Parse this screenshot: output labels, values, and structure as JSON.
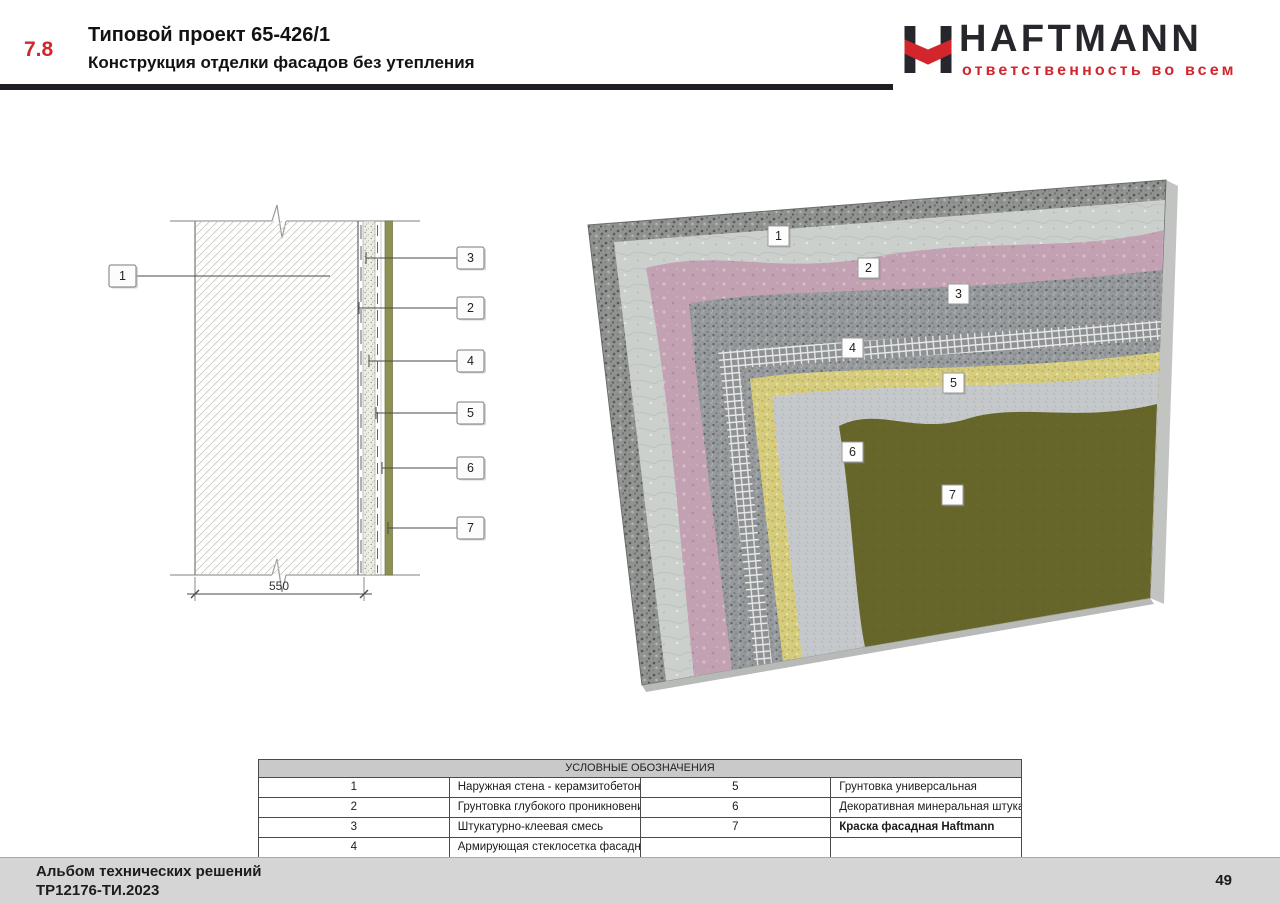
{
  "header": {
    "section_number": "7.8",
    "title": "Типовой проект 65-426/1",
    "subtitle": "Конструкция отделки фасадов без утепления",
    "accent_color": "#d3262c"
  },
  "logo": {
    "brand": "HAFTMANN",
    "tagline": "ответственность во всем",
    "brand_color": "#26262c",
    "accent_color": "#d3262c"
  },
  "drawing2d": {
    "dimension_label": "550",
    "callout_left": "1",
    "callouts_right": [
      "3",
      "2",
      "4",
      "5",
      "6",
      "7"
    ],
    "finish_strip_color": "#8d9254"
  },
  "render3d": {
    "callouts": [
      "1",
      "2",
      "3",
      "4",
      "5",
      "6",
      "7"
    ],
    "layer_colors": {
      "concrete_rough": "#90938f",
      "concrete_smooth": "#ccd0cc",
      "primer_pink": "#c2a1b3",
      "adhesive_plaster": "#96999b",
      "mesh": "#8f9294",
      "primer_yellow": "#d6cc7d",
      "mineral_plaster": "#c5c8cb",
      "paint_green": "#67662a"
    }
  },
  "legend": {
    "title": "УСЛОВНЫЕ ОБОЗНАЧЕНИЯ",
    "rows": [
      {
        "n1": "1",
        "d1": "Наружная стена - керамзитобетонные панели",
        "n2": "5",
        "d2": "Грунтовка универсальная"
      },
      {
        "n1": "2",
        "d1": "Грунтовка глубокого проникновения / Акриловая грунтовка",
        "n2": "6",
        "d2": "Декоративная минеральная штукатурка"
      },
      {
        "n1": "3",
        "d1": "Штукатурно-клеевая смесь",
        "n2": "7",
        "d2": "Краска фасадная Haftmann"
      },
      {
        "n1": "4",
        "d1": "Армирующая стеклосетка фасадная",
        "n2": "",
        "d2": ""
      }
    ]
  },
  "footer": {
    "line1": "Альбом технических решений",
    "line2": "ТР12176-ТИ.2023",
    "page_number": "49"
  }
}
